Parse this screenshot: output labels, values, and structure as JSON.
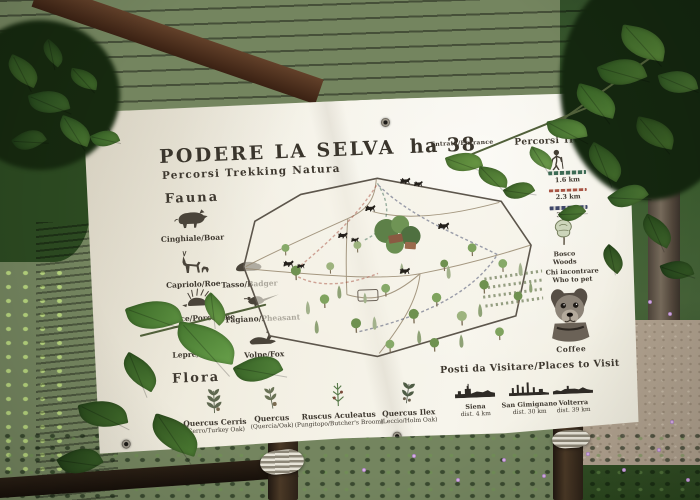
{
  "banner": {
    "title": "PODERE LA SELVA",
    "area_label": "ha 38",
    "subtitle": "Percorsi Trekking Natura",
    "fauna": {
      "heading": "Fauna",
      "items": [
        {
          "label": "Cinghiale/Boar",
          "icon": "boar-icon"
        },
        {
          "label": "Capriolo/Roe",
          "icon": "roe-deer-icon"
        },
        {
          "label": "Tasso/Badger",
          "icon": "badger-icon"
        },
        {
          "label": "Istrice/Porcupine",
          "icon": "porcupine-icon"
        },
        {
          "label": "Fagiano/Pheasant",
          "icon": "pheasant-icon"
        },
        {
          "label": "Lepre/Hare",
          "icon": "hare-icon"
        },
        {
          "label": "Volpe/Fox",
          "icon": "fox-icon"
        }
      ]
    },
    "flora": {
      "heading": "Flora",
      "items": [
        {
          "name": "Quercus Cerris",
          "common": "(Cerro/Turkey Oak)",
          "icon": "turkey-oak-sprig-icon"
        },
        {
          "name": "Quercus",
          "common": "(Quercia/Oak)",
          "icon": "oak-sprig-icon"
        },
        {
          "name": "Ruscus Aculeatus",
          "common": "(Pungitopo/Butcher's Broom)",
          "icon": "butchers-broom-sprig-icon"
        },
        {
          "name": "Quercus Ilex",
          "common": "(Leccio/Holm Oak)",
          "icon": "holm-oak-sprig-icon"
        }
      ]
    },
    "map": {
      "entrance_label": "Entrata/Entrance"
    },
    "trekking": {
      "heading": "Percorsi Trekking",
      "routes": [
        {
          "length": "1.6 km",
          "color": "#3d6b55"
        },
        {
          "length": "2.3 km",
          "color": "#a85444"
        },
        {
          "length": "3.9 km",
          "color": "#3e4668"
        }
      ],
      "woods": {
        "it": "Bosco",
        "en": "Woods"
      },
      "meet": {
        "it": "Chi incontrare",
        "en": "Who to pet"
      },
      "dog_name": "Coffee"
    },
    "places": {
      "heading": "Posti da Visitare/Places to Visit",
      "items": [
        {
          "name": "Siena",
          "distance": "dist. 4 km"
        },
        {
          "name": "San Gimignano",
          "distance": "dist. 30 km"
        },
        {
          "name": "Volterra",
          "distance": "dist. 39 km"
        }
      ]
    }
  }
}
